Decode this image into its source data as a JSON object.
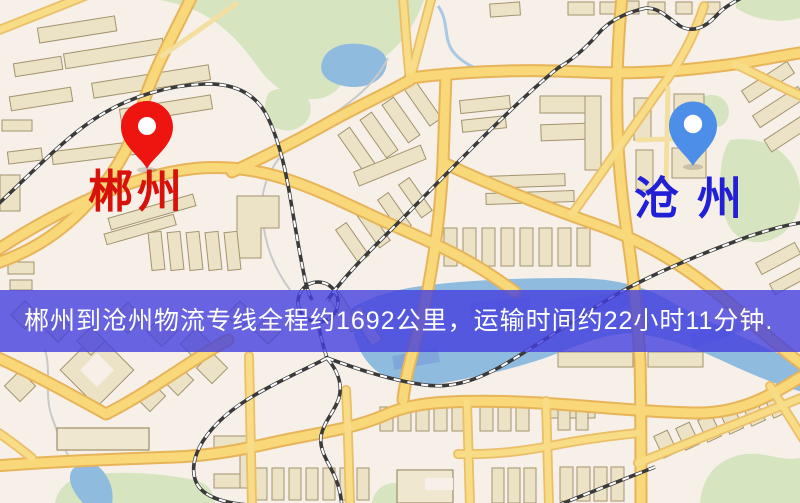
{
  "map": {
    "origin": {
      "name": "郴州",
      "pin_color": "#ee1410",
      "label_color": "#d8120b",
      "pin_icon": "origin-pin-icon"
    },
    "destination": {
      "name": "沧州",
      "pin_color": "#4d8ee8",
      "label_color": "#2120d6",
      "pin_icon": "destination-pin-icon"
    },
    "banner": {
      "text": "郴州到沧州物流专线全程约1692公里，运输时间约22小时11分钟.",
      "background_color": "#4340de",
      "text_color": "#ffffff"
    },
    "route": {
      "distance_text": "约1692公里",
      "duration_text": "约22小时11分钟"
    }
  }
}
